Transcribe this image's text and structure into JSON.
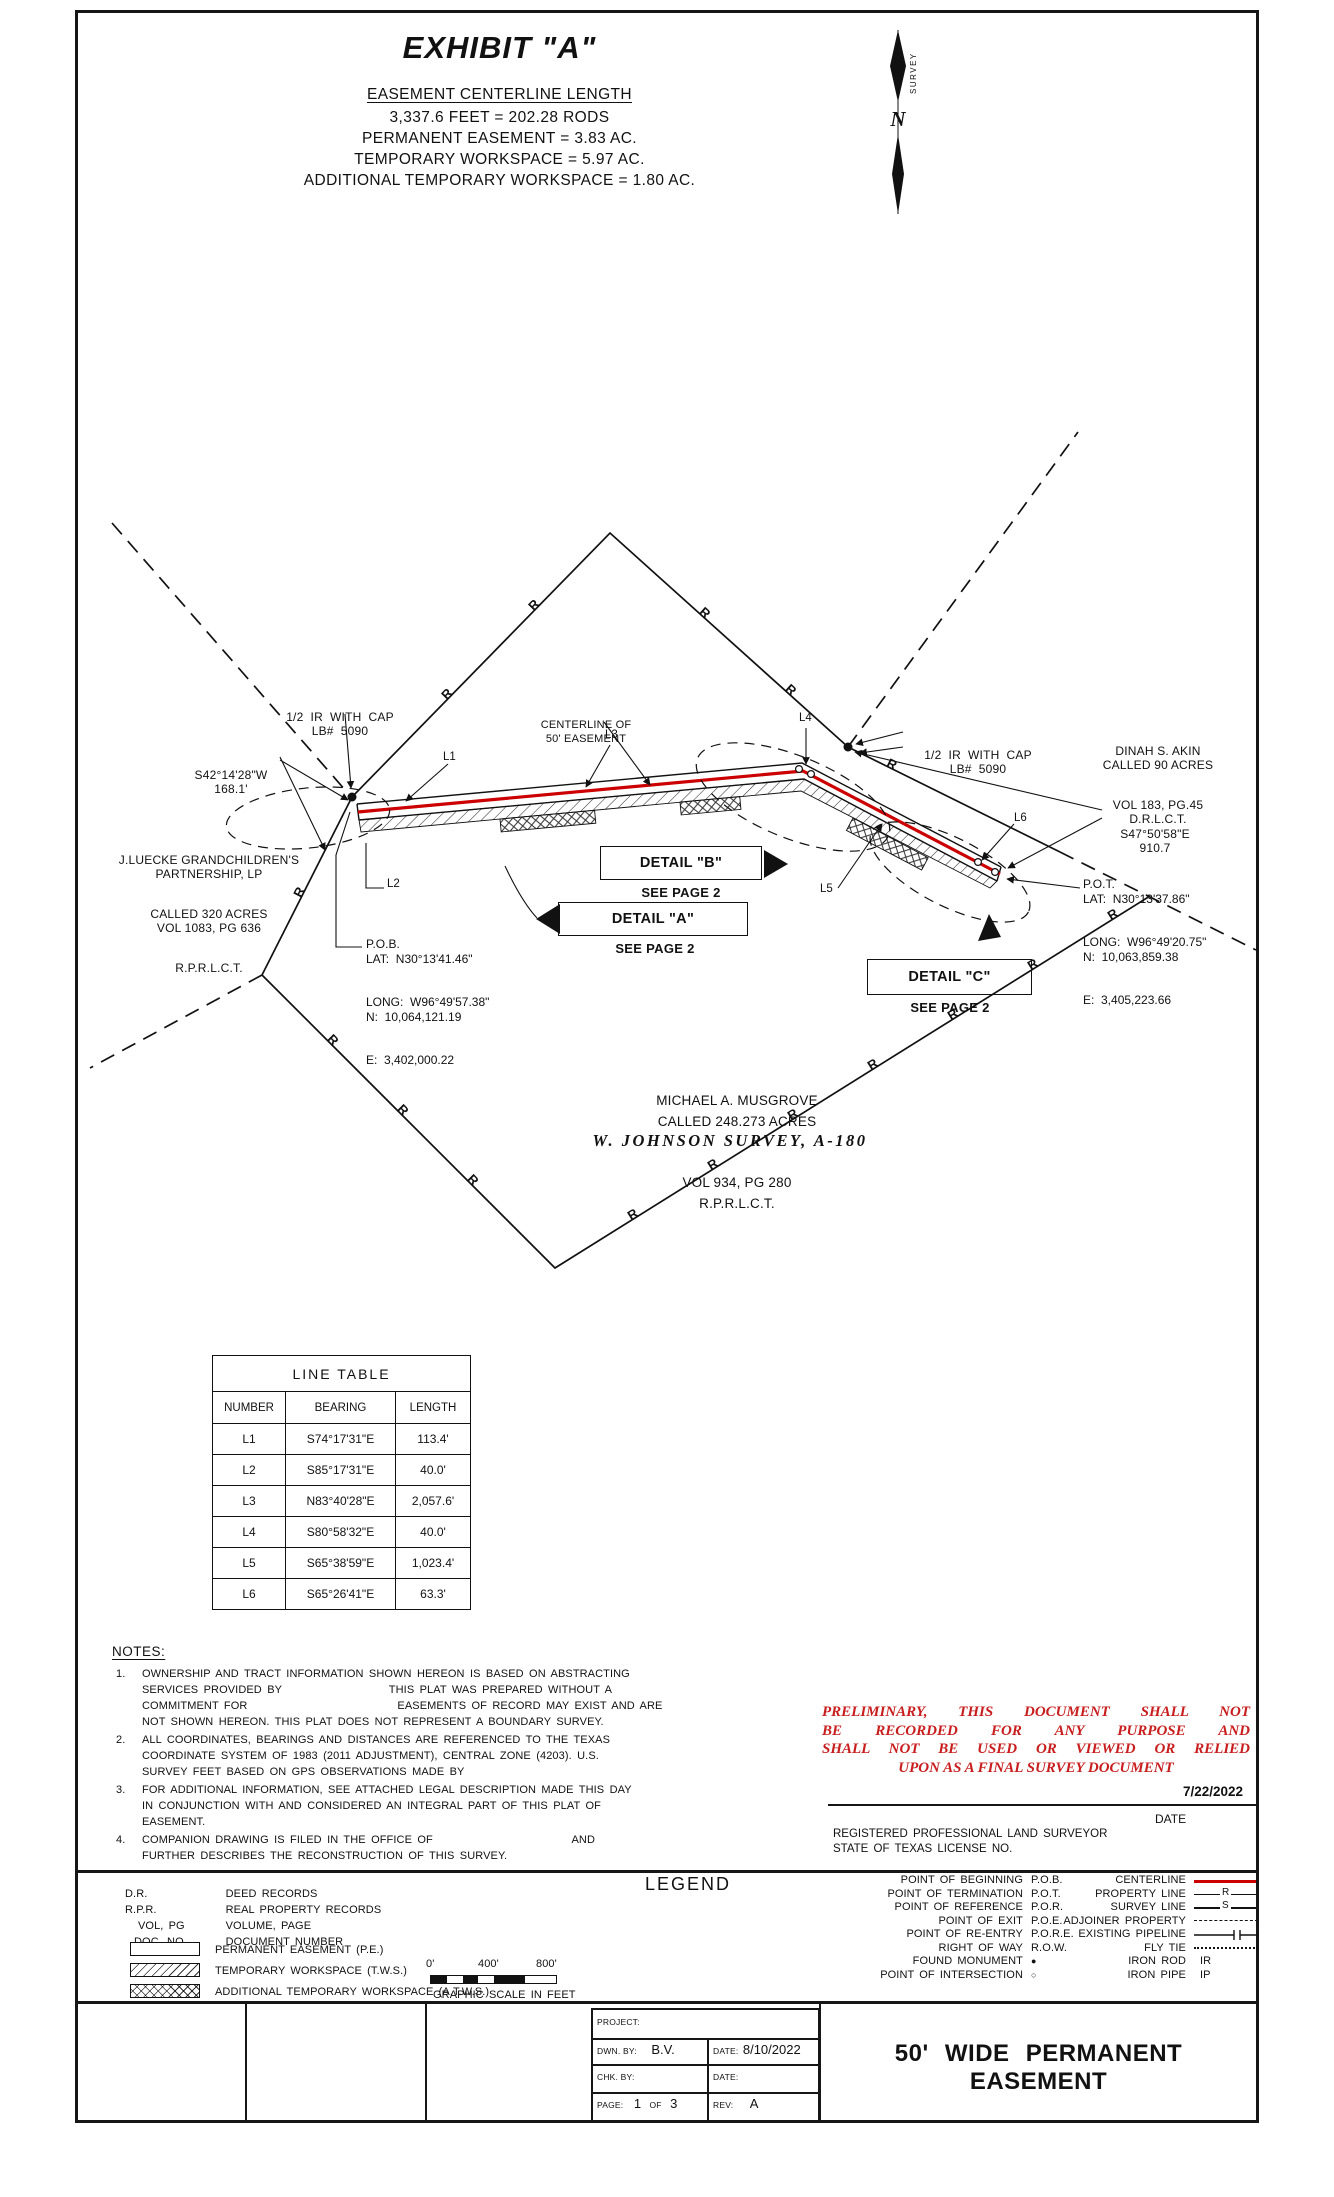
{
  "header": {
    "title": "EXHIBIT \"A\"",
    "summary_heading": "EASEMENT CENTERLINE LENGTH",
    "summary_lines": [
      "3,337.6 FEET = 202.28 RODS",
      "PERMANENT EASEMENT = 3.83 AC.",
      "TEMPORARY WORKSPACE = 5.97 AC.",
      "ADDITIONAL TEMPORARY WORKSPACE = 1.80 AC."
    ]
  },
  "north": {
    "n": "N",
    "survey": "SURVEY"
  },
  "drawing": {
    "r_marker": "R",
    "r_markers": [
      [
        450,
        697,
        -46
      ],
      [
        537,
        608,
        -46
      ],
      [
        702,
        616,
        42
      ],
      [
        788,
        693,
        42
      ],
      [
        890,
        768,
        26
      ],
      [
        303,
        894,
        -63
      ],
      [
        330,
        1043,
        45
      ],
      [
        400,
        1113,
        45
      ],
      [
        470,
        1183,
        45
      ],
      [
        635,
        1218,
        -32
      ],
      [
        715,
        1168,
        -32
      ],
      [
        795,
        1118,
        -32
      ],
      [
        875,
        1068,
        -32
      ],
      [
        955,
        1018,
        -32
      ],
      [
        1035,
        968,
        -32
      ],
      [
        1115,
        918,
        -32
      ]
    ],
    "line_labels": [
      "L1",
      "L2",
      "L3",
      "L4",
      "L5",
      "L6"
    ],
    "labels": {
      "ir_cap_left": [
        "1/2  IR  WITH  CAP",
        "LB#  5090"
      ],
      "bearing_west": [
        "S42°14'28\"W",
        "168.1'"
      ],
      "centerline": [
        "CENTERLINE OF",
        "50' EASEMENT"
      ],
      "ir_cap_right": [
        "1/2  IR  WITH  CAP",
        "LB#  5090"
      ],
      "akin": [
        "DINAH S. AKIN",
        "CALLED 90 ACRES",
        "VOL 183, PG.45",
        "D.R.L.C.T."
      ],
      "bearing_east": [
        "S47°50'58\"E",
        "910.7"
      ],
      "pob": [
        "P.O.B.",
        "LAT:  N30°13'41.46\"",
        "LONG:  W96°49'57.38\"",
        "N:  10,064,121.19",
        "E:  3,402,000.22"
      ],
      "pot": [
        "P.O.T.",
        "LAT:  N30°13'37.86\"",
        "LONG:  W96°49'20.75\"",
        "N:  10,063,859.38",
        "E:  3,405,223.66"
      ],
      "luecke": [
        "J.LUECKE GRANDCHILDREN'S",
        "PARTNERSHIP, LP",
        "CALLED 320 ACRES",
        "VOL 1083, PG 636",
        "R.P.R.L.C.T."
      ],
      "musgrove": [
        "MICHAEL A. MUSGROVE",
        "CALLED 248.273 ACRES",
        "VOL 934, PG 280",
        "R.P.R.L.C.T."
      ],
      "survey_name": "W. JOHNSON SURVEY, A-180",
      "detail_a": [
        "DETAIL \"A\"",
        "SEE PAGE 2"
      ],
      "detail_b": [
        "DETAIL \"B\"",
        "SEE PAGE 2"
      ],
      "detail_c": [
        "DETAIL \"C\"",
        "SEE PAGE 2"
      ]
    }
  },
  "line_table": {
    "title": "LINE  TABLE",
    "headers": [
      "NUMBER",
      "BEARING",
      "LENGTH"
    ],
    "rows": [
      [
        "L1",
        "S74°17'31\"E",
        "113.4'"
      ],
      [
        "L2",
        "S85°17'31\"E",
        "40.0'"
      ],
      [
        "L3",
        "N83°40'28\"E",
        "2,057.6'"
      ],
      [
        "L4",
        "S80°58'32\"E",
        "40.0'"
      ],
      [
        "L5",
        "S65°38'59\"E",
        "1,023.4'"
      ],
      [
        "L6",
        "S65°26'41\"E",
        "63.3'"
      ]
    ]
  },
  "notes": {
    "heading": "NOTES:",
    "items": [
      {
        "num": "1.",
        "lines": [
          "OWNERSHIP AND TRACT INFORMATION SHOWN HEREON IS BASED ON ABSTRACTING",
          "SERVICES PROVIDED BY                    THIS PLAT WAS PREPARED WITHOUT A",
          "COMMITMENT FOR                            EASEMENTS OF RECORD MAY EXIST AND ARE",
          "NOT SHOWN HEREON. THIS PLAT DOES NOT REPRESENT A BOUNDARY SURVEY."
        ]
      },
      {
        "num": "2.",
        "lines": [
          "ALL COORDINATES, BEARINGS AND DISTANCES ARE REFERENCED TO THE TEXAS",
          "COORDINATE SYSTEM OF 1983 (2011 ADJUSTMENT), CENTRAL ZONE (4203). U.S.",
          "SURVEY FEET BASED ON GPS OBSERVATIONS MADE BY"
        ]
      },
      {
        "num": "3.",
        "lines": [
          "FOR ADDITIONAL INFORMATION, SEE ATTACHED LEGAL DESCRIPTION MADE THIS DAY",
          "IN CONJUNCTION WITH AND CONSIDERED AN INTEGRAL PART OF THIS PLAT OF",
          "EASEMENT."
        ]
      },
      {
        "num": "4.",
        "lines": [
          "COMPANION DRAWING IS FILED IN THE OFFICE OF                          AND",
          "FURTHER DESCRIBES THE RECONSTRUCTION OF THIS SURVEY."
        ]
      }
    ]
  },
  "preliminary": {
    "lines": [
      "PRELIMINARY, THIS DOCUMENT SHALL NOT",
      "BE RECORDED FOR ANY PURPOSE AND",
      "SHALL NOT BE USED OR VIEWED OR RELIED",
      "UPON AS A FINAL SURVEY DOCUMENT"
    ],
    "color": "#c81e1e"
  },
  "signature": {
    "date_value": "7/22/2022",
    "date_label": "DATE",
    "surveyor": "REGISTERED PROFESSIONAL LAND SURVEYOR",
    "license": "STATE OF TEXAS LICENSE NO."
  },
  "legend": {
    "heading": "LEGEND",
    "abbrevs": [
      [
        "D.R.",
        "DEED RECORDS"
      ],
      [
        "R.P.R.",
        "REAL PROPERTY RECORDS"
      ],
      [
        "VOL, PG",
        "VOLUME, PAGE"
      ],
      [
        "DOC. NO.",
        "DOCUMENT NUMBER"
      ]
    ],
    "swatches": [
      "PERMANENT EASEMENT (P.E.)",
      "TEMPORARY WORKSPACE (T.W.S.)",
      "ADDITIONAL TEMPORARY WORKSPACE (A.T.W.S.)"
    ],
    "scale": {
      "ticks": [
        "0'",
        "400'",
        "800'"
      ],
      "caption": "GRAPHIC SCALE IN FEET"
    },
    "points": [
      [
        "POINT OF BEGINNING",
        "P.O.B."
      ],
      [
        "POINT OF TERMINATION",
        "P.O.T."
      ],
      [
        "POINT OF REFERENCE",
        "P.O.R."
      ],
      [
        "POINT OF EXIT",
        "P.O.E."
      ],
      [
        "POINT OF RE-ENTRY",
        "P.O.R.E."
      ],
      [
        "RIGHT OF WAY",
        "R.O.W."
      ],
      [
        "FOUND MONUMENT",
        "●"
      ],
      [
        "POINT OF INTERSECTION",
        "○"
      ]
    ],
    "line_types": [
      "CENTERLINE",
      "PROPERTY LINE",
      "SURVEY LINE",
      "ADJOINER PROPERTY",
      "EXISTING PIPELINE",
      "FLY TIE",
      "IRON ROD",
      "IRON PIPE"
    ],
    "glyph_r": "R",
    "glyph_s": "S",
    "iron_rod_abbr": "IR",
    "iron_pipe_abbr": "IP",
    "centerline_color": "#cc0000"
  },
  "title_block": {
    "project_label": "PROJECT:",
    "dwn_label": "DWN. BY:",
    "dwn_value": "B.V.",
    "date1_label": "DATE:",
    "date1_value": "8/10/2022",
    "chk_label": "CHK. BY:",
    "date2_label": "DATE:",
    "page_label": "PAGE:",
    "page_value": "1",
    "page_of": "OF",
    "page_total": "3",
    "rev_label": "REV:",
    "rev_value": "A",
    "main_title": "50' WIDE PERMANENT EASEMENT"
  }
}
